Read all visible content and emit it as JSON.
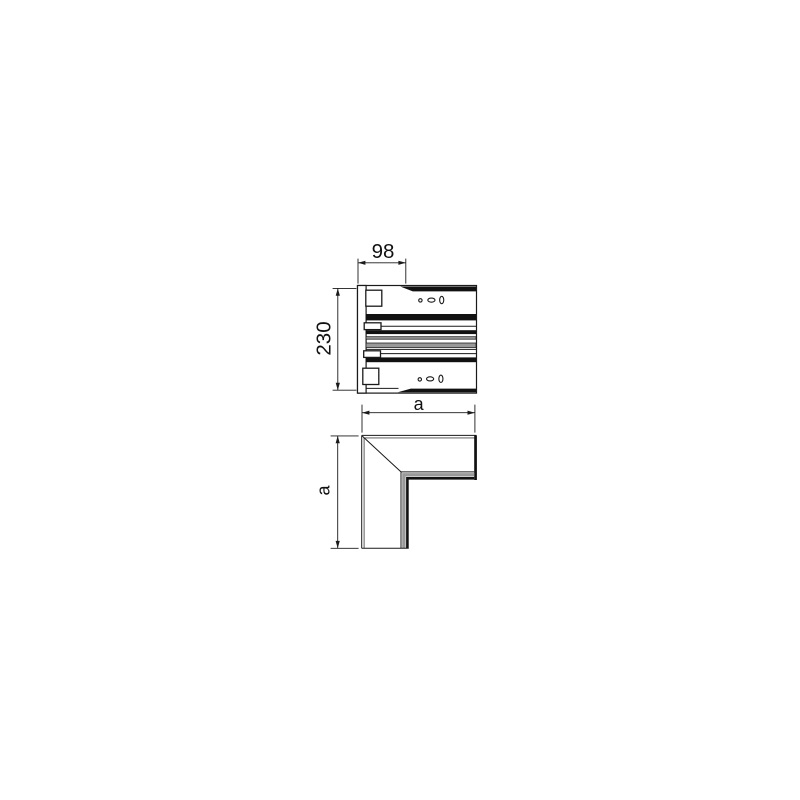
{
  "labels": {
    "top_view_width": "98",
    "top_view_height": "230",
    "front_view_width": "a",
    "front_view_height": "a"
  },
  "colors": {
    "line": "#1a1a1a",
    "dark_fill": "#111111",
    "gray_fill": "#999999",
    "background": "#ffffff"
  }
}
